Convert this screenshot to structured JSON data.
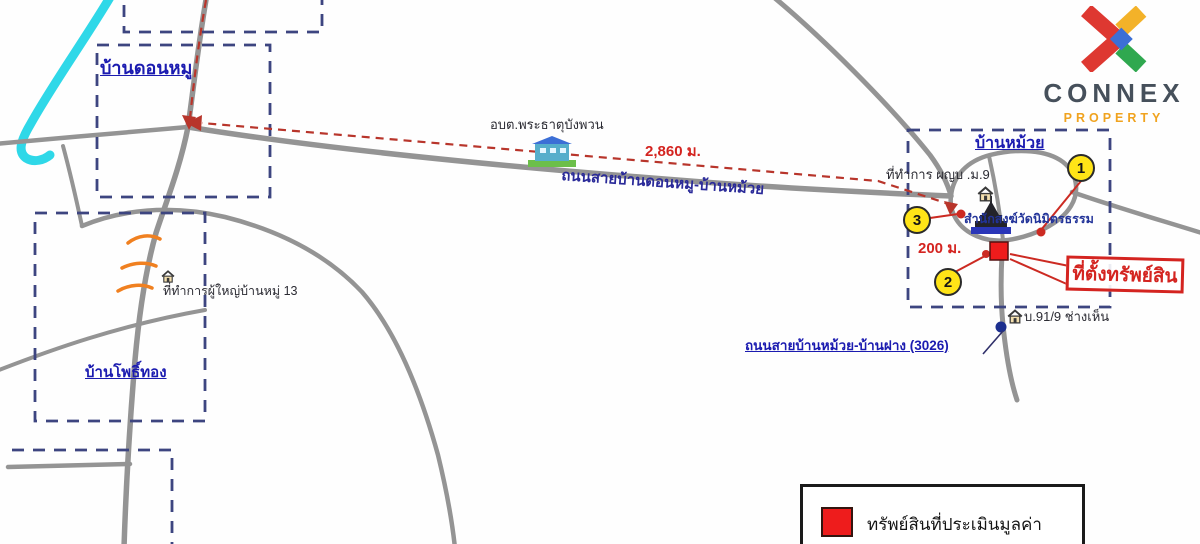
{
  "logo": {
    "brand": "CONNEX",
    "tagline": "PROPERTY"
  },
  "villages": {
    "northwest": "บ้านดอนหมู",
    "southwest": "บ้านโพธิ์ทอง",
    "east": "บ้านหม้วย"
  },
  "roads": {
    "main_label": "ถนนสายบ้านดอนหมู-บ้านหม้วย",
    "south_label": "ถนนสายบ้านหม้วย-บ้านฝาง (3026)"
  },
  "places": {
    "sao_office": "อบต.พระธาตุบังพวน",
    "village_headman_m13": "ที่ทำการผู้ใหญ่บ้านหมู่ 13",
    "village_headman_m9": "ที่ทำการ ผญบ .ม.9",
    "temple": "สำนักสงฆ์วัดนิมิตรธรรม",
    "house_91_9": "บ.91/9 ช่างเห็น"
  },
  "distances": {
    "to_sao": "2,860 ม.",
    "to_junction": "200 ม."
  },
  "markers": {
    "m1": "1",
    "m2": "2",
    "m3": "3"
  },
  "property": {
    "callout": "ที่ตั้งทรัพย์สิน"
  },
  "legend": {
    "item1": "ทรัพย์สินที่ประเมินมูลค่า"
  },
  "colors": {
    "road_gray": "#949494",
    "river_cyan": "#2fd8e8",
    "boundary_navy": "#3d4580",
    "route_red": "#b8352b",
    "property_red": "#ee1c1c",
    "label_navy": "#1b1bb0",
    "marker_yellow": "#ffe417"
  }
}
